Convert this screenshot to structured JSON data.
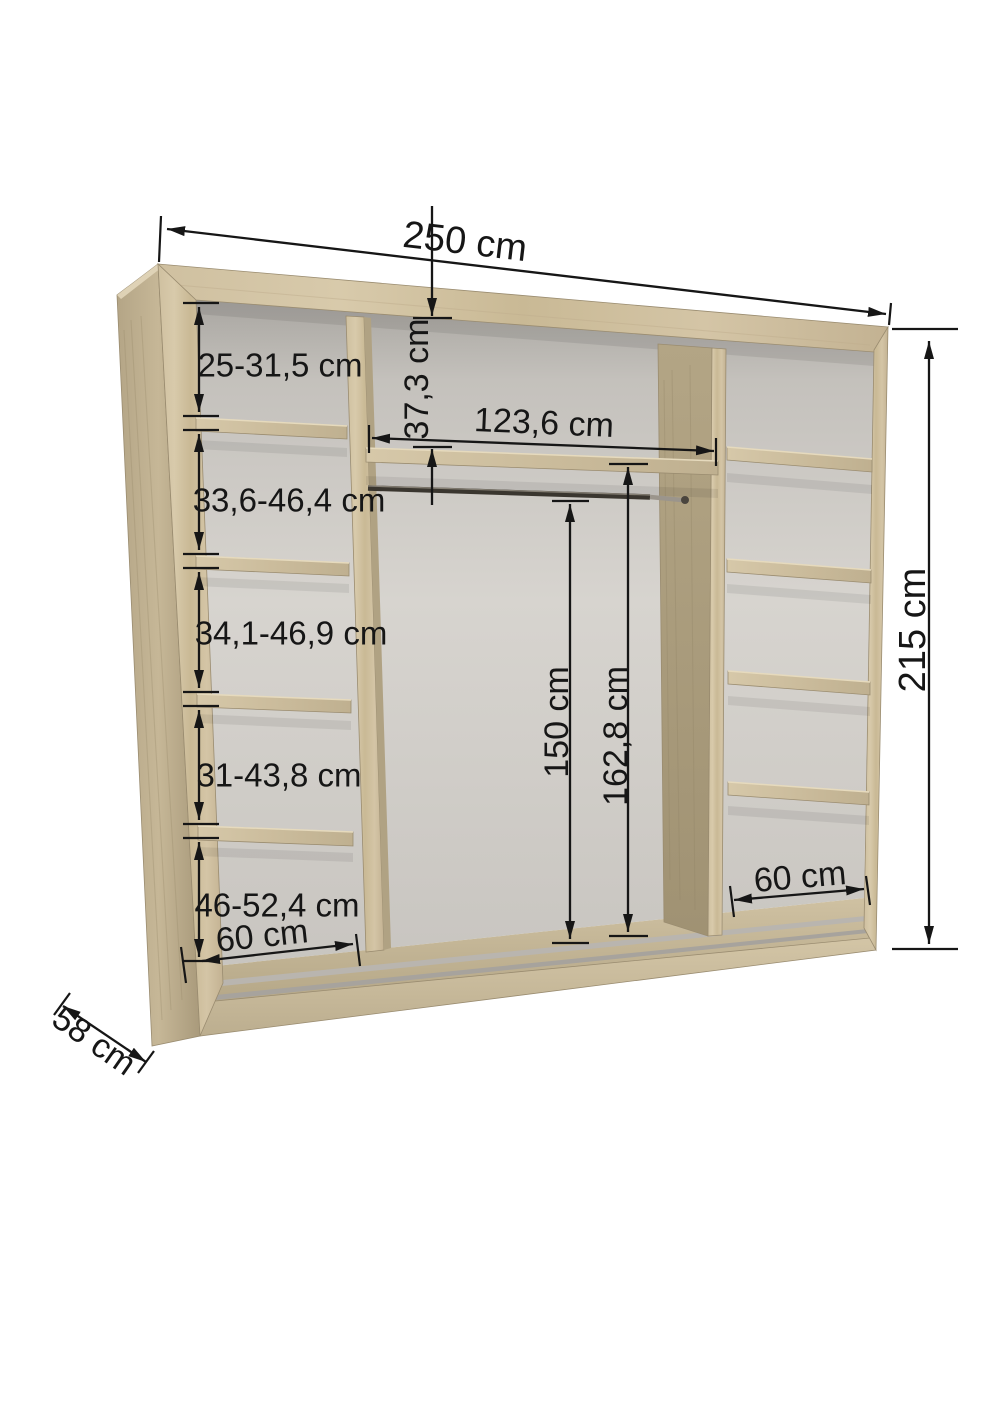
{
  "diagram": {
    "type": "wardrobe-interior-dimension-drawing",
    "background_color": "#ffffff",
    "dimension_color": "#161616",
    "wood_color": "#cdbe9e",
    "wood_dark_color": "#ab9d7d",
    "back_panel_color": "#d3d0cb",
    "labels": {
      "total_width": "250 cm",
      "total_height": "215 cm",
      "depth": "58 cm",
      "left_section_width": "60 cm",
      "right_section_width": "60 cm",
      "center_section_width": "123,6 cm",
      "top_compartment_height": "37,3 cm",
      "rail_clearance_height": "150 cm",
      "center_compartment_height": "162,8 cm",
      "left_compartment_1": "25-31,5 cm",
      "left_compartment_2": "33,6-46,4 cm",
      "left_compartment_3": "34,1-46,9 cm",
      "left_compartment_4": "31-43,8 cm",
      "left_compartment_5": "46-52,4 cm"
    }
  }
}
